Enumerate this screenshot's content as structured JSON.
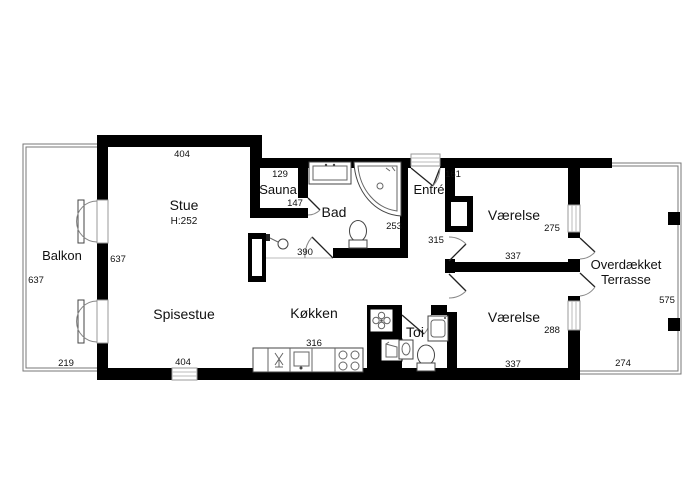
{
  "title": "floor-plan",
  "rooms": {
    "balkon": "Balkon",
    "stue": "Stue",
    "stue_height": "H:252",
    "spisestue": "Spisestue",
    "sauna": "Sauna",
    "bad": "Bad",
    "kokken": "Køkken",
    "toi": "Toi",
    "entre": "Entré",
    "vaerelse1": "Værelse",
    "vaerelse2": "Værelse",
    "terrasse_line1": "Overdækket",
    "terrasse_line2": "Terrasse"
  },
  "dims": {
    "stue_top": "404",
    "left_wall_inner": "637",
    "balkon_side": "637",
    "balkon_bottom": "219",
    "sauna_width": "129",
    "sauna_depth": "147",
    "bad_width": "390",
    "bad_depth": "253",
    "entre_width": "161",
    "hall_length": "315",
    "vaerelse1_width": "337",
    "vaerelse1_depth": "275",
    "vaerelse2_width": "337",
    "vaerelse2_depth": "288",
    "spisestue_window": "404",
    "kokken_counter": "316",
    "terrasse_side": "575",
    "terrasse_bottom": "274"
  },
  "icons": {
    "fan": "fan-icon",
    "shower": "shower-icon",
    "stove": "stove-icon",
    "sink": "sink-icon",
    "toilet": "toilet-icon",
    "bathtub": "bathtub-icon",
    "washer": "washing-machine-icon"
  },
  "colors": {
    "wall": "#000000",
    "background": "#ffffff",
    "window": "#999999",
    "door_arc": "#888888"
  }
}
